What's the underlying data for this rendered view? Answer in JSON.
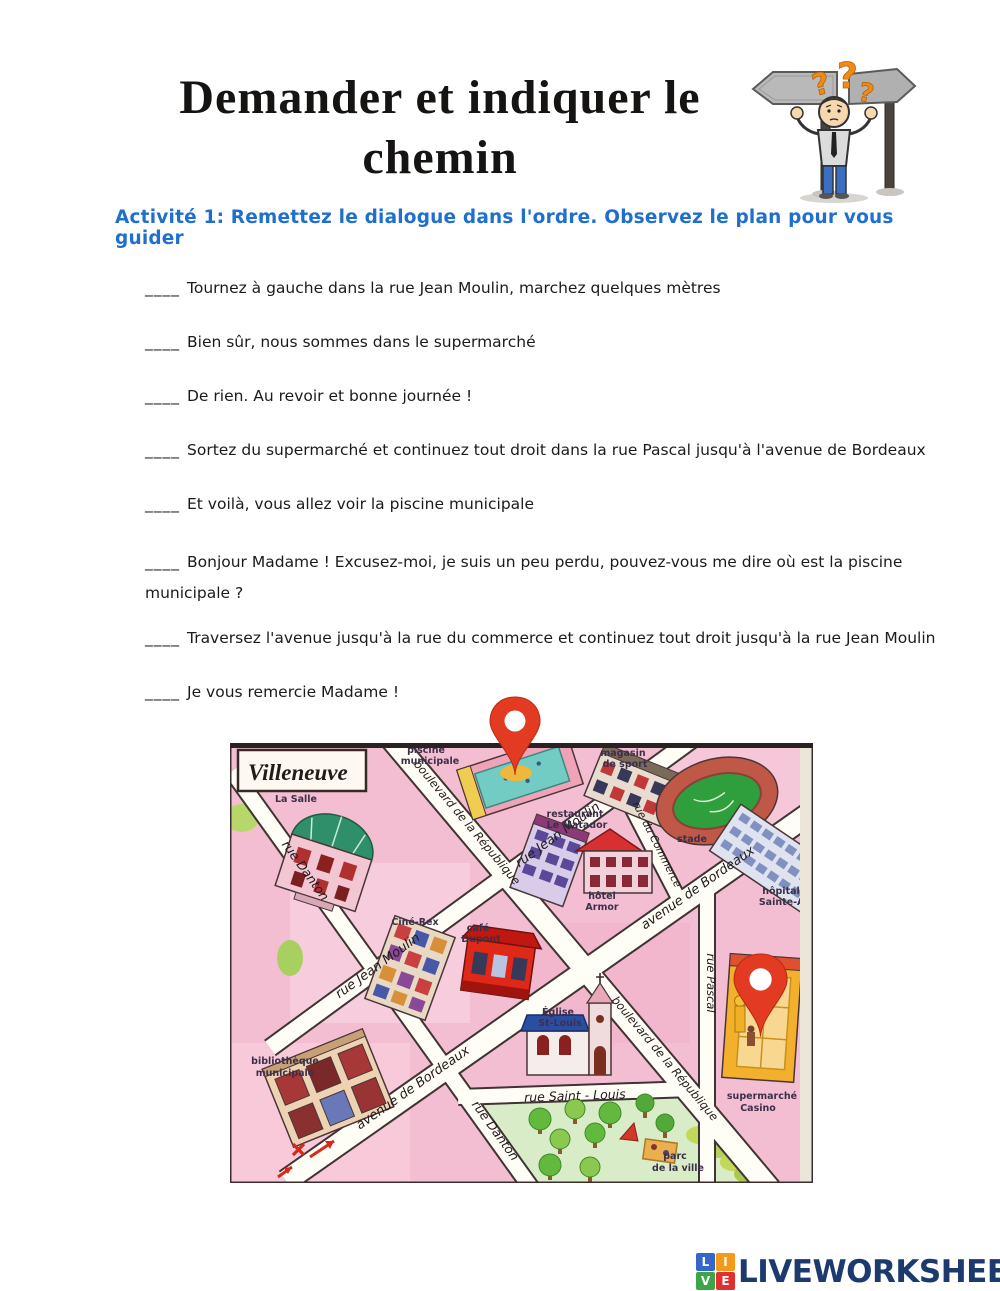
{
  "header": {
    "title_line1": "Demander et indiquer le",
    "title_line2": "chemin",
    "subtitle": "Activité 1: Remettez le dialogue dans l'ordre. Observez le plan pour vous guider",
    "question_mark": "?"
  },
  "dialogue": {
    "blank": "____",
    "items": [
      "Tournez à gauche dans la rue Jean Moulin, marchez quelques mètres",
      "Bien sûr, nous sommes dans le supermarché",
      "De rien. Au revoir et bonne journée !",
      "Sortez du supermarché et continuez tout droit dans la rue Pascal jusqu'à l'avenue de Bordeaux",
      "Et voilà, vous allez voir la piscine municipale",
      "Bonjour Madame ! Excusez-moi, je suis un peu perdu, pouvez-vous me dire où est la piscine municipale ?",
      "Traversez l'avenue jusqu'à la rue du commerce et continuez tout droit jusqu'à la rue Jean Moulin",
      "Je vous remercie Madame !"
    ]
  },
  "map": {
    "town_name": "Villeneuve",
    "streets": {
      "danton_top": "rue Danton",
      "danton_bottom": "rue Danton",
      "jean_moulin_lower": "rue Jean Moulin",
      "jean_moulin_upper": "rue Jean Moulin",
      "republique_upper": "boulevard de la République",
      "republique_lower": "boulevard de la République",
      "bordeaux_upper": "avenue de Bordeaux",
      "bordeaux_lower": "avenue de Bordeaux",
      "commerce": "rue du Commerce",
      "pascal": "rue Pascal",
      "saint_louis": "rue  Saint - Louis"
    },
    "places": {
      "musee_1": "musée",
      "musee_2": "La Salle",
      "piscine_1": "piscine",
      "piscine_2": "municipale",
      "magasin_1": "magasin",
      "magasin_2": "de sport",
      "stade": "stade",
      "hopital_1": "hôpital",
      "hopital_2": "Sainte-An",
      "restaurant_1": "restaurant",
      "restaurant_2": "Le Matador",
      "hotel_1": "hôtel",
      "hotel_2": "Armor",
      "cine": "Ciné-Rex",
      "cafe_1": "café",
      "cafe_2": "Dupont",
      "eglise_1": "Église",
      "eglise_2": "St-Louis",
      "biblio_1": "bibliothèque",
      "biblio_2": "municipale",
      "supermarche_1": "supermarché",
      "supermarche_2": "Casino",
      "parc_1": "parc",
      "parc_2": "de la ville"
    },
    "colors": {
      "pin": "#e23b22",
      "background": "#f4bed2",
      "street": "#fffef6",
      "park": "#d8ecc8",
      "pool": "#72ccc4",
      "stadium_field": "#2f9e3c"
    }
  },
  "footer": {
    "logo_letters": [
      "L",
      "I",
      "V",
      "E"
    ],
    "logo_text": "LIVEWORKSHEETS"
  }
}
